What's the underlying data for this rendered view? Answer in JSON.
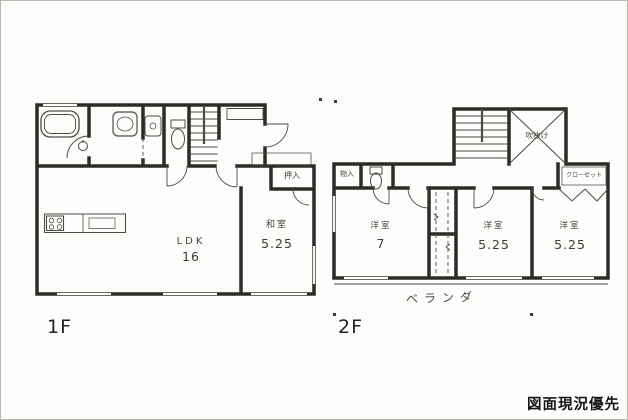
{
  "canvas": {
    "note": "図面現況優先"
  },
  "floor1": {
    "label": "1F",
    "rooms": {
      "ldk": {
        "name": "LDK",
        "size": "16"
      },
      "washitsu": {
        "name": "和室",
        "size": "5.25"
      },
      "oshiire": {
        "name": "押入"
      }
    }
  },
  "floor2": {
    "label": "2F",
    "rooms": {
      "west1": {
        "name": "洋室",
        "size": "7"
      },
      "west2": {
        "name": "洋室",
        "size": "5.25"
      },
      "west3": {
        "name": "洋室",
        "size": "5.25"
      },
      "storage": {
        "name": "物入"
      },
      "closet": {
        "name": "クローゼット"
      },
      "void": {
        "name": "吹抜け"
      },
      "balcony": {
        "name": "ベランダ"
      }
    }
  },
  "icons": [
    "bathtub-icon",
    "vanity-icon",
    "washer-pan-icon",
    "toilet-icon",
    "stairs-icon",
    "stove-icon",
    "sink-icon",
    "void-x-icon",
    "door-arc",
    "window",
    "closet-fold-doors"
  ],
  "colors": {
    "wall": "#2b2b27",
    "thin_line": "#4c4c45",
    "text": "#45443b",
    "background": "#fdfdfc"
  }
}
